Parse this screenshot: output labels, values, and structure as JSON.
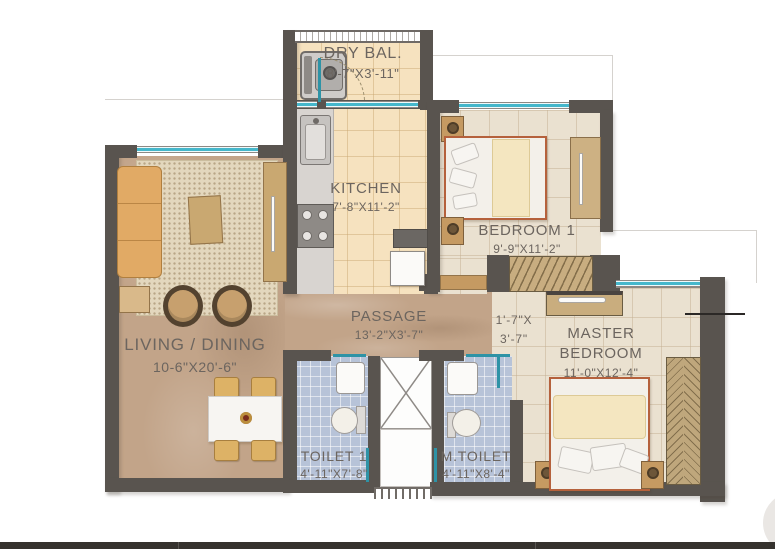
{
  "plan_title": "2BHK apartment floor plan",
  "rooms": {
    "dry_bal": {
      "name": "DRY BAL.",
      "dim": "8'-7\"X3'-11\""
    },
    "kitchen": {
      "name": "KITCHEN",
      "dim": "7'-8\"X11'-2\""
    },
    "bedroom1": {
      "name": "BEDROOM 1",
      "dim": "9'-9\"X11'-2\""
    },
    "living": {
      "name": "LIVING / DINING",
      "dim": "10-6\"X20'-6\""
    },
    "passage": {
      "name": "PASSAGE",
      "dim": "13'-2\"X3'-7\""
    },
    "mini_passage": {
      "line1": "1'-7\"X",
      "line2": "3'-7\""
    },
    "master": {
      "line1": "MASTER",
      "line2": "BEDROOM",
      "dim": "11'-0\"X12'-4\""
    },
    "toilet1": {
      "name": "TOILET 1",
      "dim": "4'-11\"X7'-8\""
    },
    "mtoilet": {
      "name": "M.TOILET",
      "dim": "4'-11\"X8'-4\""
    }
  },
  "colors": {
    "wall": "#59544f",
    "window_teal": "#45b7cb",
    "kitchen_floor": "#f6e2bf",
    "bedroom_floor": "#eae1d0",
    "toilet_floor": "#b7c3d8",
    "marble_floor": "#c2a489",
    "bed_frame_accent": "#b5613c",
    "label_text": "#6c655f",
    "bottom_bar": "#35322e"
  }
}
